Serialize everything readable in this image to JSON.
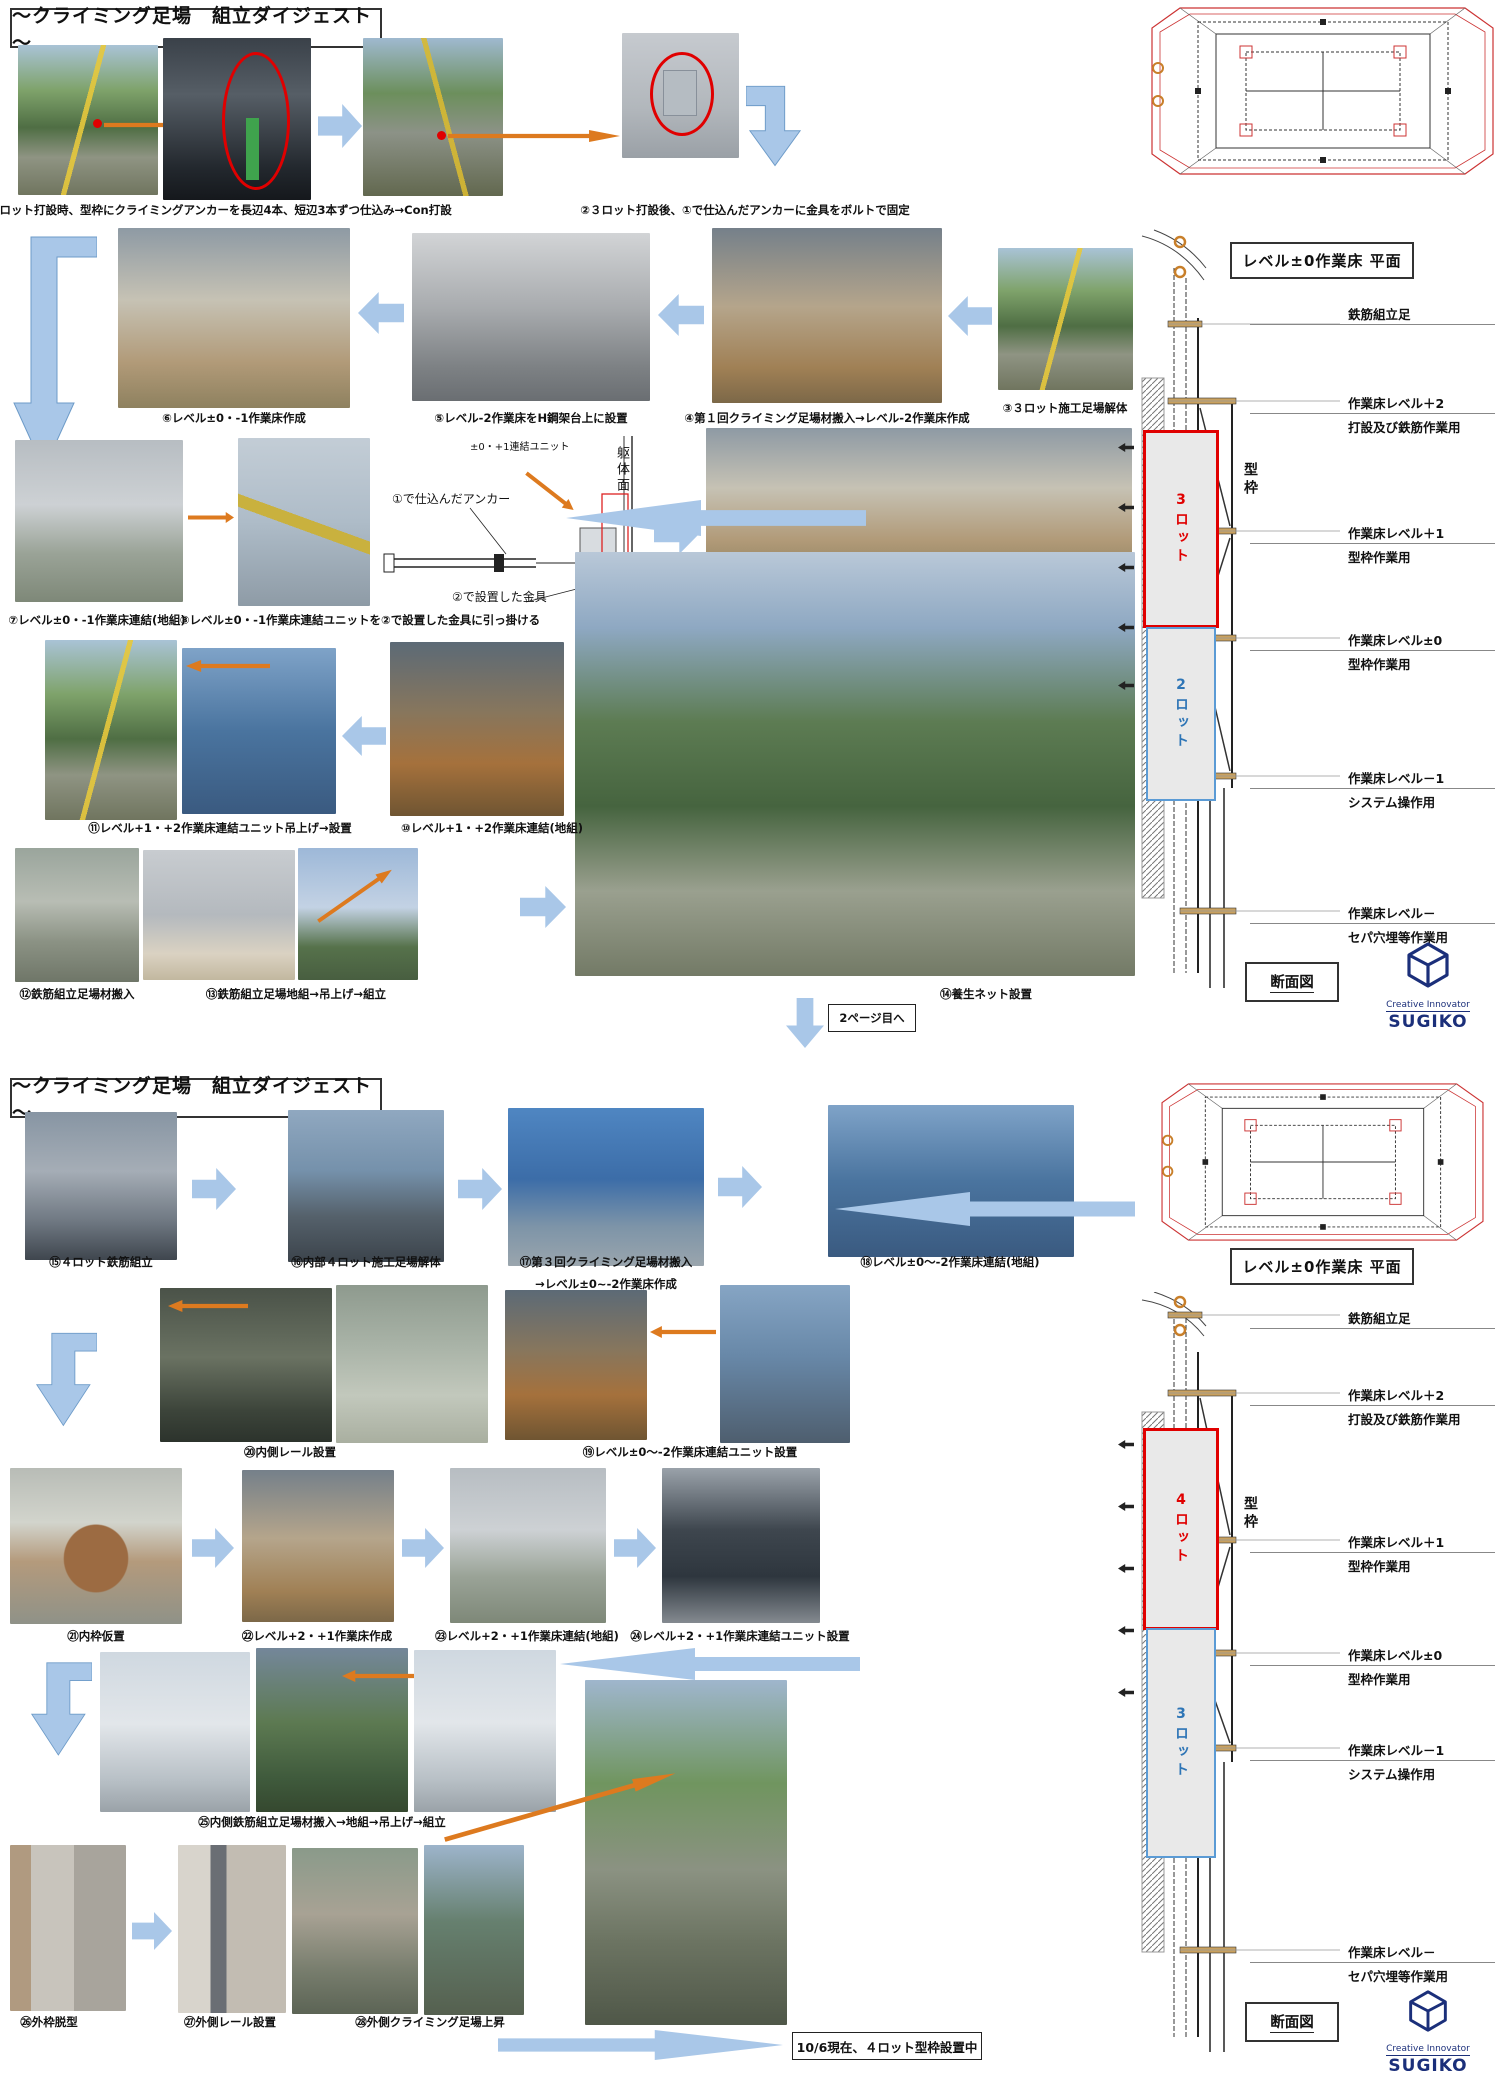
{
  "page1": {
    "title": "～クライミング足場　組立ダイジェスト～",
    "captions": {
      "c01": "①２ロット打設時、型枠にクライミングアンカーを長辺4本、短辺3本ずつ仕込み→Con打設",
      "c02": "②３ロット打設後、①で仕込んだアンカーに金具をボルトで固定",
      "c03": "③３ロット施工足場解体",
      "c04": "④第１回クライミング足場材搬入→レベル-2作業床作成",
      "c05": "⑤レベル-2作業床をH鋼架台上に設置",
      "c06": "⑥レベル±0・-1作業床作成",
      "c07": "⑦レベル±0・-1作業床連結(地組)",
      "c08": "⑧レベル±0・-1作業床連結ユニットを②で設置した金具に引っ掛ける",
      "c09a": "⑨第２回クライミング足場材搬入",
      "c09b": "→レベル+1・+2作業床作成",
      "c10": "⑩レベル+1・+2作業床連結(地組)",
      "c11": "⑪レベル+1・+2作業床連結ユニット吊上げ→設置",
      "c12": "⑫鉄筋組立足場材搬入",
      "c13": "⑬鉄筋組立足場地組→吊上げ→組立",
      "c14": "⑭養生ネット設置"
    },
    "diagram": {
      "unit_label": "±0・+1連結ユニット",
      "wall_label": "躯体面",
      "anchor_label": "①で仕込んだアンカー",
      "bracket_label": "②で設置した金具"
    },
    "next_page": "2ページ目へ"
  },
  "page2": {
    "title": "～クライミング足場　組立ダイジェスト～",
    "captions": {
      "c15": "⑮４ロット鉄筋組立",
      "c16": "⑯内部４ロット施工足場解体",
      "c17a": "⑰第３回クライミング足場材搬入",
      "c17b": "→レベル±0~-2作業床作成",
      "c18": "⑱レベル±0～-2作業床連結(地組)",
      "c19": "⑲レベル±0～-2作業床連結ユニット設置",
      "c20": "⑳内側レール設置",
      "c21": "㉑内枠仮置",
      "c22": "㉒レベル+2・+1作業床作成",
      "c23": "㉓レベル+2・+1作業床連結(地組)",
      "c24": "㉔レベル+2・+1作業床連結ユニット設置",
      "c25": "㉕内側鉄筋組立足場材搬入→地組→吊上げ→組立",
      "c26": "㉖外枠脱型",
      "c27": "㉗外側レール設置",
      "c28": "㉘外側クライミング足場上昇"
    },
    "status_note": "10/6現在、４ロット型枠設置中"
  },
  "drawing1": {
    "plan_title": "レベル±0作業床 平面",
    "section_title": "断面図",
    "lot_upper": "3ロット",
    "lot_lower": "2ロット",
    "frame_label": "型枠",
    "levels": [
      {
        "name": "鉄筋組立足",
        "use": ""
      },
      {
        "name": "作業床レベル＋2",
        "use": "打設及び鉄筋作業用"
      },
      {
        "name": "作業床レベル＋1",
        "use": "型枠作業用"
      },
      {
        "name": "作業床レベル±0",
        "use": "型枠作業用"
      },
      {
        "name": "作業床レベル－1",
        "use": "システム操作用"
      },
      {
        "name": "作業床レベル－",
        "use": "セパ穴埋等作業用"
      }
    ]
  },
  "drawing2": {
    "plan_title": "レベル±0作業床 平面",
    "section_title": "断面図",
    "lot_upper": "4ロット",
    "lot_lower": "3ロット",
    "frame_label": "型枠",
    "levels": [
      {
        "name": "鉄筋組立足",
        "use": ""
      },
      {
        "name": "作業床レベル＋2",
        "use": "打設及び鉄筋作業用"
      },
      {
        "name": "作業床レベル＋1",
        "use": "型枠作業用"
      },
      {
        "name": "作業床レベル±0",
        "use": "型枠作業用"
      },
      {
        "name": "作業床レベル－1",
        "use": "システム操作用"
      },
      {
        "name": "作業床レベル－",
        "use": "セパ穴埋等作業用"
      }
    ]
  },
  "logo": {
    "tagline": "Creative Innovator",
    "name": "SUGIKO"
  },
  "colors": {
    "accent_blue": "#a9c7e8",
    "accent_orange": "#dd7a1f",
    "highlight_red": "#e00000",
    "lot_red": "#e00000",
    "lot_blue": "#2e75b6",
    "logo_navy": "#1b2f7a"
  }
}
